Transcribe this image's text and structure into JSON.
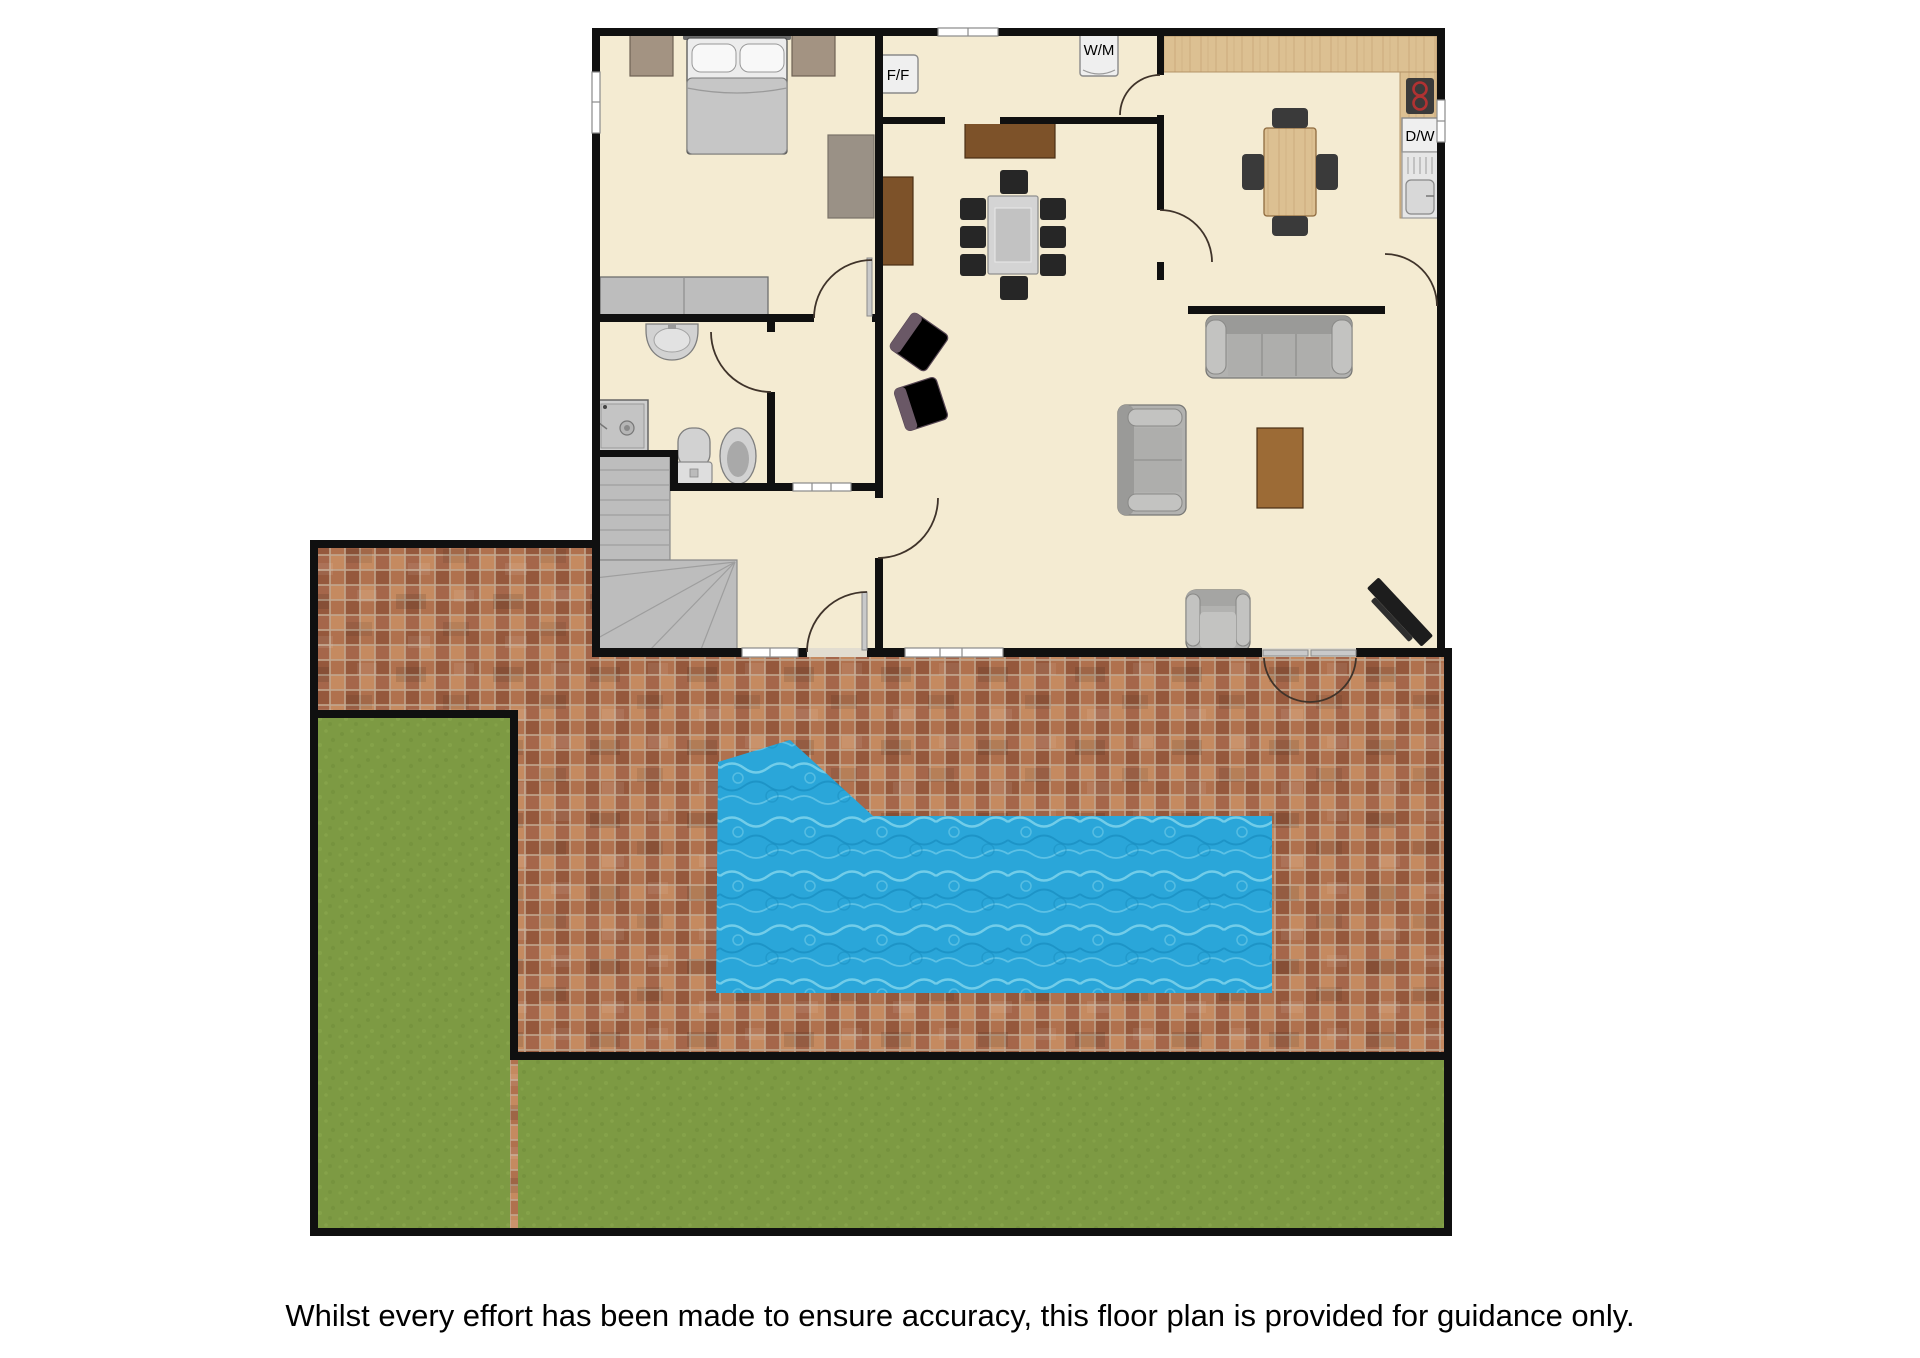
{
  "disclaimer": "Whilst every effort has been made to ensure accuracy, this floor plan is provided for guidance only.",
  "appliances": {
    "fridge_freezer": "F/F",
    "washing_machine": "W/M",
    "dishwasher": "D/W"
  },
  "colors": {
    "wall": "#101010",
    "floor": "#f4ebd2",
    "door_arc": "#3f332a",
    "text": "#000000",
    "brick_grout": "#c2a78f",
    "brick_base": "#b0714e",
    "brick_dark": "#95583c",
    "brick_light": "#c58a60",
    "brick_mid": "#a5664a",
    "grass_base": "#7d9a43",
    "grass_dark": "#6f8c3a",
    "grass_light": "#8ca94e",
    "pool_base": "#2aa6d9",
    "pool_ripple": "#7fd4ec",
    "pool_ripple_dark": "#1488ba",
    "counter_wood": "#dcc092",
    "counter_grain": "#c09e6e",
    "furniture_gray": "#b2b2b0",
    "furniture_gray_dark": "#787876",
    "wood_brown": "#7d5229",
    "wood_brown_light": "#9c6b36",
    "wood_brown_dark": "#4a2f14",
    "chair_black": "#262626",
    "appliance_bg": "#efefef",
    "hob_red": "#b03232"
  }
}
